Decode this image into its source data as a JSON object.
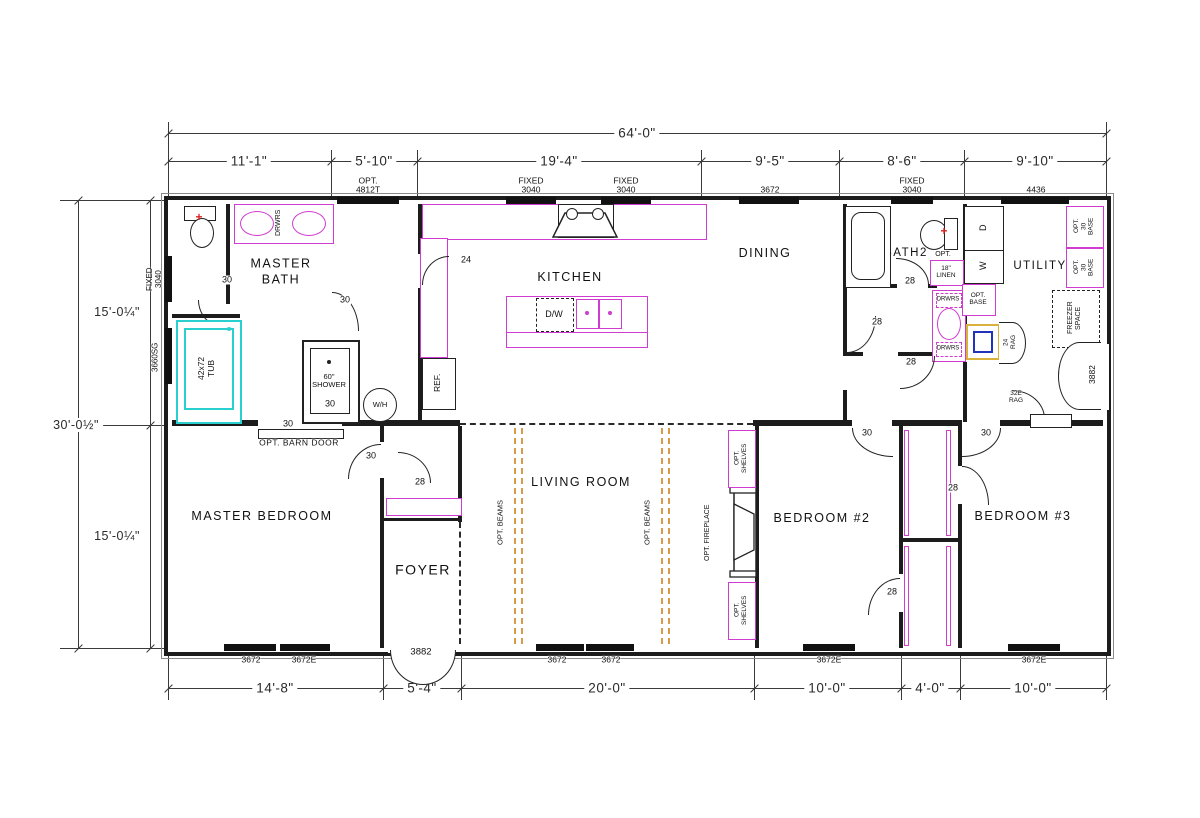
{
  "drawing": {
    "type": "manufactured-home floor plan",
    "floor_texture_color": "#4fd8d8"
  },
  "dimensions": {
    "overall_width": "64'-0\"",
    "top_row": [
      "11'-1\"",
      "5'-10\"",
      "19'-4\"",
      "9'-5\"",
      "8'-6\"",
      "9'-10\""
    ],
    "bottom_row": [
      "14'-8\"",
      "5'-4\"",
      "20'-0\"",
      "10'-0\"",
      "4'-0\"",
      "10'-0\""
    ],
    "left_upper": "15'-0¼\"",
    "left_lower": "15'-0¼\"",
    "left_total": "30'-0½\""
  },
  "rooms": {
    "master_bath": "MASTER\nBATH",
    "kitchen": "KITCHEN",
    "dining": "DINING",
    "bath2": "BATH2",
    "utility": "UTILITY",
    "master_bedroom": "MASTER  BEDROOM",
    "foyer": "FOYER",
    "living_room": "LIVING  ROOM",
    "bedroom2": "BEDROOM  #2",
    "bedroom3": "BEDROOM  #3"
  },
  "windows": {
    "opt_transom": "OPT.\n4812T",
    "fixed_3040": "FIXED\n3040",
    "dining_window": "3672",
    "utility_window": "4436",
    "left_window_upper": "FIXED\n3040",
    "left_window_lower": "3660SG",
    "w_3672": "3672",
    "w_3672e": "3672E"
  },
  "doors": {
    "size_24": "24",
    "size_28": "28",
    "size_30": "30",
    "front_door": "3882",
    "rear_door": "3882",
    "barn_door": "OPT. BARN DOOR"
  },
  "labels": {
    "tub": "42x72\nTUB",
    "shower": "60\"\nSHOWER",
    "water_heater": "W/H",
    "fridge": "REF.",
    "dishwasher": "D/W",
    "drawers": "DRWRS",
    "opt": "OPT.",
    "linen": "18\"\nLINEN",
    "opt_base": "OPT.\nBASE",
    "opt_30_base": "OPT.\n30\nBASE",
    "freezer_space": "FREEZER\nSPACE",
    "dryer": "D",
    "washer": "W",
    "rag_24": "24\nRAG",
    "rag_32e": "32E\nRAG",
    "pb": "P/B",
    "opt_beams": "OPT. BEAMS",
    "opt_shelves": "OPT.\nSHELVES",
    "opt_fireplace": "OPT. FIREPLACE"
  },
  "colors": {
    "tile": "#4fd8d8",
    "fixture_magenta": "#cf3ccf",
    "beam_orange": "#d79b4b",
    "wall_black": "#1c1c1c",
    "marker_red": "#dd2222",
    "tub_cyan": "#2ad0d0",
    "sink_blue": "#2233bb",
    "sink_yellow": "#d8b23a"
  }
}
